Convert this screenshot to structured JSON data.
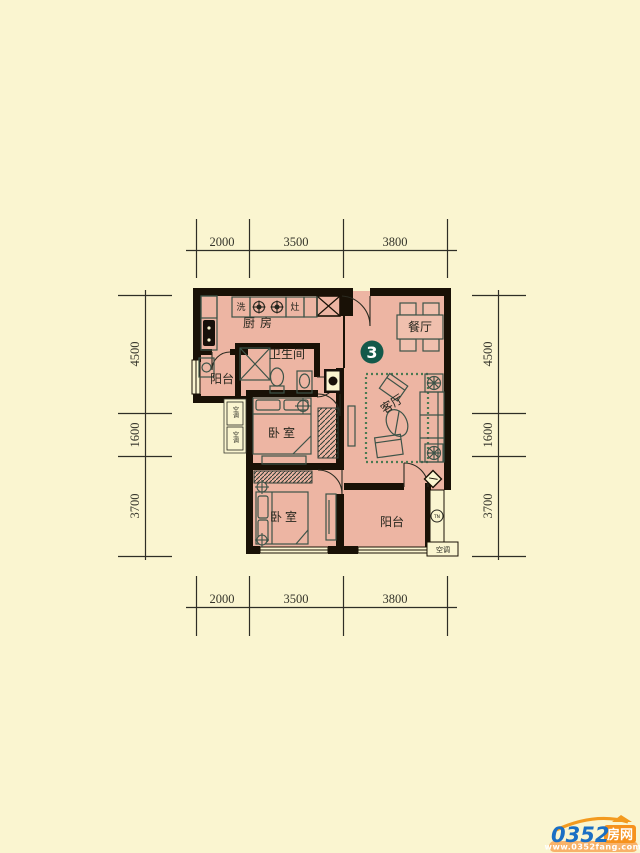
{
  "unit": {
    "badge": "3"
  },
  "dims": {
    "top": [
      "2000",
      "3500",
      "3800"
    ],
    "bottom": [
      "2000",
      "3500",
      "3800"
    ],
    "left": [
      "4500",
      "1600",
      "3700"
    ],
    "right": [
      "4500",
      "1600",
      "3700"
    ]
  },
  "rooms": {
    "kitchen": "厨房",
    "bathroom": "卫生间",
    "balcony_left": "阳台",
    "dining": "餐厅",
    "living": "客厅",
    "bedroom_1": "卧室",
    "bedroom_2": "卧室",
    "balcony_south": "阳台"
  },
  "annotations": {
    "ac_unit": "空调",
    "ac_platform_1": "空调",
    "ac_platform_2": "空调",
    "meter": "TN",
    "counter_a": "洗",
    "counter_b": "灶"
  },
  "watermark": {
    "number": "0352",
    "name": "房网",
    "url": "www.0352fang.com"
  },
  "colors": {
    "background": "#faf5d0",
    "floor": "#edb5a3",
    "wall": "#191106",
    "furniture_line": "#3d5348",
    "rug_green": "#4a7a52",
    "badge_green": "#14594a",
    "brand_blue": "#1a6fc4",
    "brand_orange": "#f6921e"
  }
}
